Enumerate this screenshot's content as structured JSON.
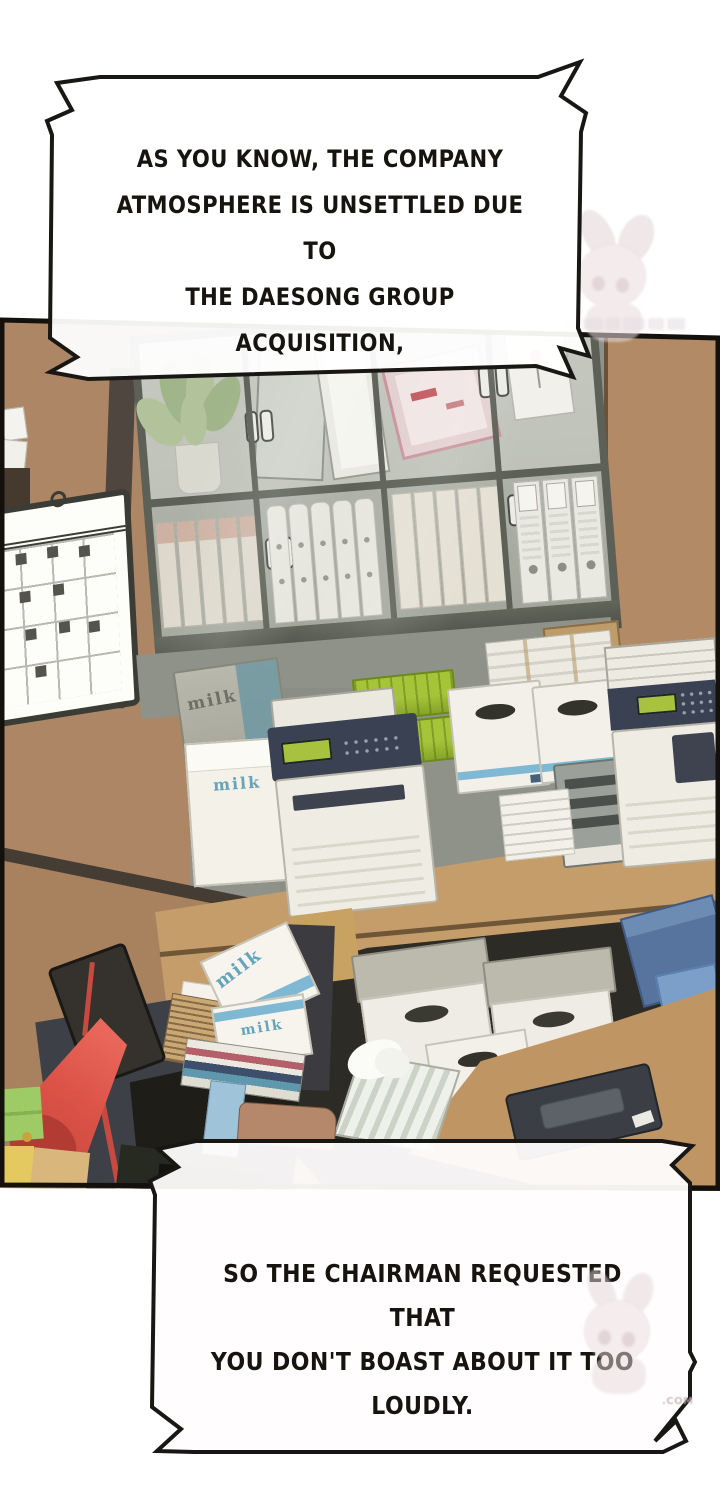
{
  "bubbles": {
    "top": {
      "lines": [
        "AS YOU KNOW, THE COMPANY",
        "ATMOSPHERE IS UNSETTLED DUE TO",
        "THE DAESONG GROUP",
        "ACQUISITION,"
      ]
    },
    "bottom": {
      "lines": [
        "SO THE CHAIRMAN REQUESTED THAT",
        "YOU DON'T BOAST ABOUT IT TOO",
        "LOUDLY."
      ]
    }
  },
  "scene": {
    "milk_label": "milk"
  },
  "watermark": {
    "site_suffix": ".COM"
  },
  "colors": {
    "ink": "#17140f",
    "wall-brown": "#ad8765",
    "wall-dark": "#4e4a47",
    "pillar": "#b28a66",
    "partition": "#a8815f",
    "beam": "#453d33",
    "cabinet-frame": "#5d6056",
    "glass-a": "#bfc2b8",
    "glass-b": "#adb1a7",
    "gray-wall": "#8f9288",
    "table-wood": "#c59d6b",
    "desk-wood": "#bf9663",
    "under-dark": "#2c2b25",
    "milk-blue": "#64a4bc",
    "crate-green": "#a6c437",
    "lamp-red": "#dd5348",
    "lcd-green": "#a6c23e",
    "printer-dark": "#3a4152",
    "printer-body": "#efece3",
    "box-blue-a": "#56749e",
    "box-blue-b": "#7c9fc9",
    "sticky-green": "#9ecb66",
    "sticky-yellow": "#e3c95f",
    "sticky-tan": "#d9b67c"
  }
}
